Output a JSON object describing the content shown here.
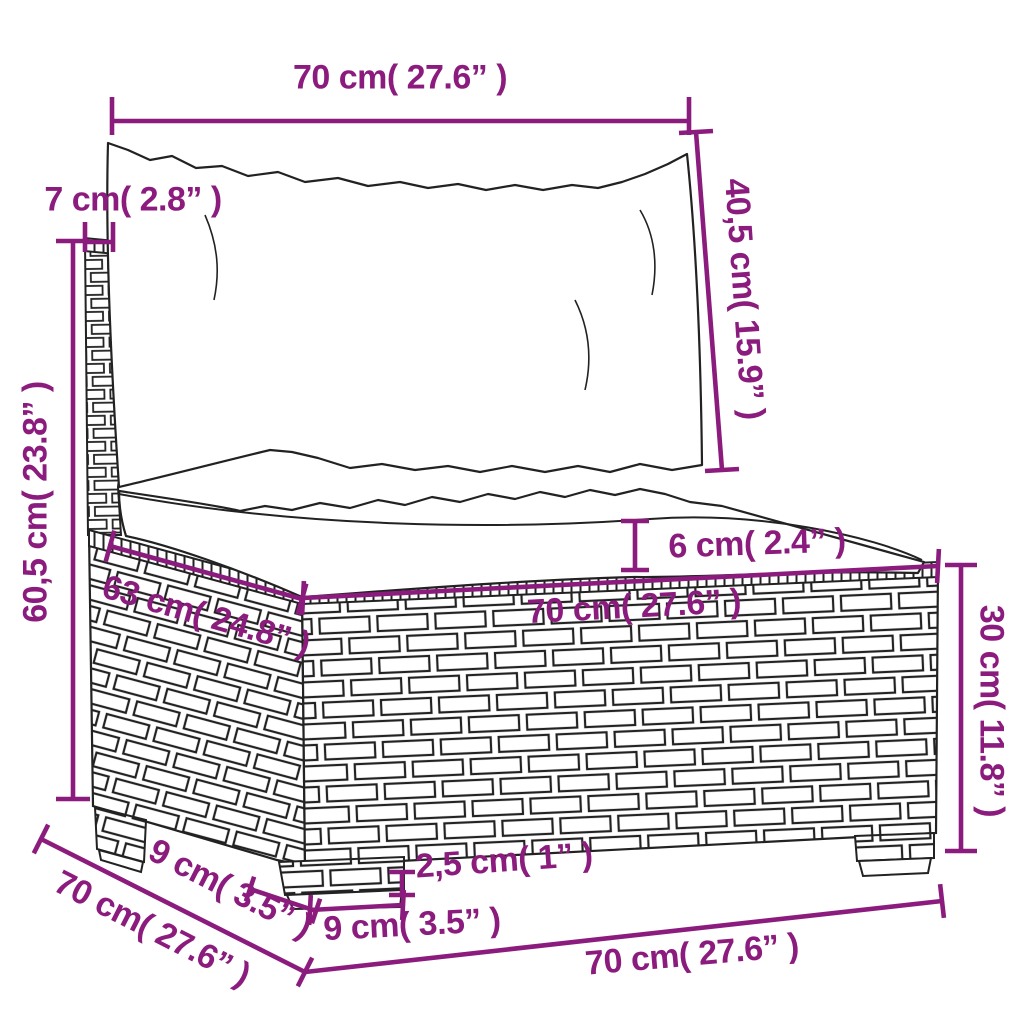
{
  "diagram": {
    "subject": "poly rattan garden middle sofa with cushions - dimension drawing",
    "colors": {
      "dimension_accent": "#8b1c7e",
      "line_art": "#222222",
      "background": "#ffffff"
    },
    "dimensions": {
      "back_cushion_width": "70 cm( 27.6” )",
      "back_cushion_height": "40,5 cm( 15.9” )",
      "back_frame_thickness": "7 cm( 2.8” )",
      "backrest_height": "60,5 cm( 23.8” )",
      "seat_depth": "63 cm( 24.8” )",
      "seat_cushion_thickness": "6 cm( 2.4” )",
      "seat_width": "70 cm( 27.6” )",
      "base_height": "30 cm( 11.8” )",
      "foot_height": "2,5 cm( 1” )",
      "front_leg_width": "9 cm( 3.5” )",
      "side_leg_depth": "9 cm( 3.5” )",
      "total_depth": "70 cm( 27.6” )",
      "total_width": "70 cm( 27.6” )"
    }
  }
}
